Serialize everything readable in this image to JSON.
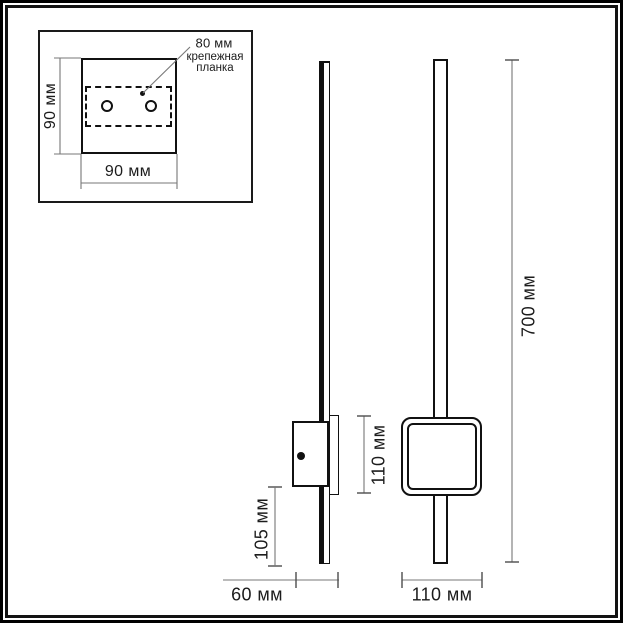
{
  "drawing": {
    "type": "wall-lamp dimensional drawing",
    "inset": {
      "height_label": "90 мм",
      "width_label": "90 мм",
      "hole_spacing_label": "80 мм",
      "callout_line1": "крепежная",
      "callout_line2": "планка"
    },
    "side_view": {
      "offset_label": "105 мм",
      "depth_label": "60 мм"
    },
    "front_view": {
      "square_label": "110 мм",
      "height_label": "700 мм",
      "width_label": "110 мм"
    },
    "colors": {
      "object_line": "#111111",
      "dimension_line": "#777777",
      "tick": "#4d4d4d",
      "text": "#1c1c1c",
      "background": "#ffffff"
    }
  }
}
